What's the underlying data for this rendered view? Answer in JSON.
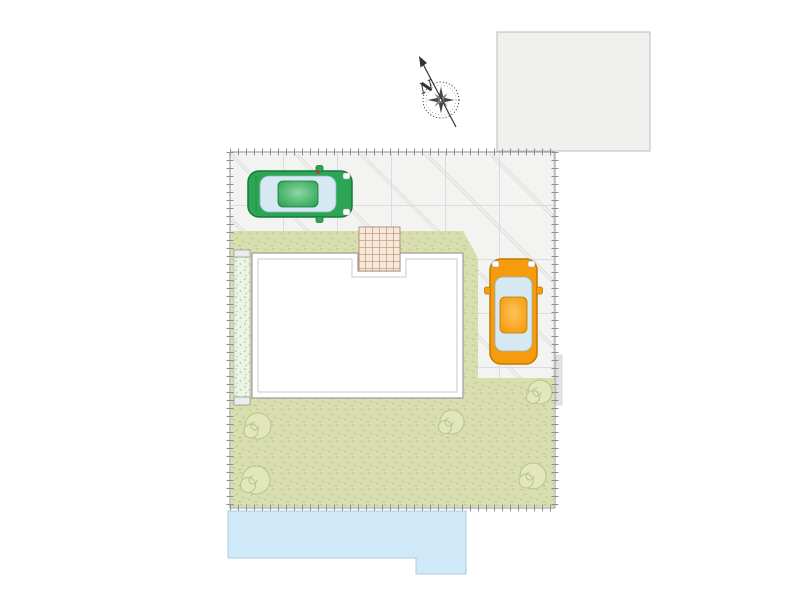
{
  "compass": {
    "label": "N"
  },
  "colors": {
    "page_bg": "#ffffff",
    "building_fill": "#f0f0ef",
    "building_border": "#c6c6c6",
    "paving_fill": "#f3f3f1",
    "paving_grid": "#dcdcdc",
    "paving_diag": "#dadada",
    "lawn_fill": "#d8deae",
    "lawn_speckle": "#b7bf8c",
    "mint_fill": "#ebf4e6",
    "mint_dot": "#a5cc9f",
    "mint_border": "#b0b0b0",
    "cap_fill": "#ededed",
    "cap_border": "#9a9a9a",
    "house_fill": "#ffffff",
    "house_border": "#9e9e9e",
    "house_border_inner": "#c9c9c9",
    "brick_fill": "#f7e9da",
    "brick_line": "#c89e86",
    "brick_border": "#b0937e",
    "road_fill": "#cfe9f8",
    "road_border": "#a9cde2",
    "boundary_line": "#8f8f8f",
    "bush_fill": "#e1e6bd",
    "bush_stroke": "#b9c287",
    "wall_strip": "#e2e2e2",
    "car_green_body": "#2ca654",
    "car_green_dark": "#137a38",
    "car_orange_body": "#f59b0c",
    "car_orange_dark": "#bf7a00",
    "car_glass": "#d6e9f2",
    "car_glass_stroke": "#8fb6c4",
    "headlight": "#ffffff",
    "headlight_stroke": "#999999",
    "antenna": "#d03030",
    "compass_ink": "#333333"
  },
  "scene": {
    "type": "residential site plan",
    "cars": [
      {
        "id": "green-car",
        "orientation": "facing-east",
        "location": "north-driveway"
      },
      {
        "id": "orange-car",
        "orientation": "facing-north",
        "location": "east-parking-bay"
      }
    ],
    "bush_count": 5,
    "features": [
      "neighboring-building",
      "compass-north-arrow",
      "paved-driveway",
      "lawn-garden",
      "gravel-strip",
      "house-footprint",
      "entrance-tiles",
      "road"
    ]
  }
}
